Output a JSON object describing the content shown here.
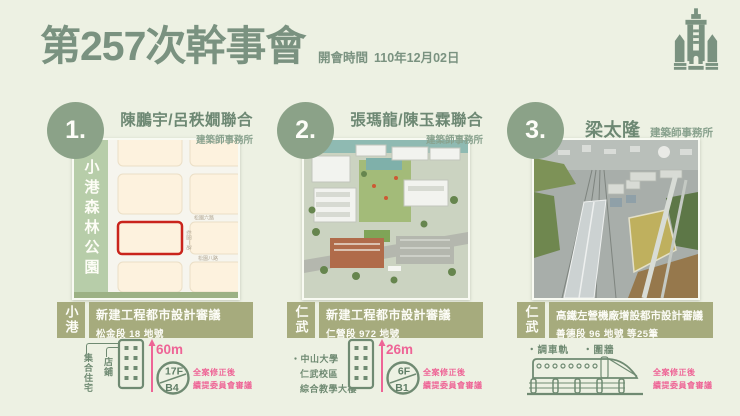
{
  "colors": {
    "accent_green": "#7a9280",
    "circle_green": "#8ba288",
    "banner_olive": "#a6ab7d",
    "pink": "#ee6496",
    "map_red": "#c9241c"
  },
  "header": {
    "title": "第257次幹事會",
    "meeting_time_label": "開會時間",
    "meeting_date": "110年12月02日"
  },
  "panels": [
    {
      "number": "1.",
      "firm": "陳鵬宇/呂秩嫺聯合",
      "firm_suffix": "建築師事務所",
      "district": "小港",
      "case_title": "新建工程都市設計審議",
      "case_lot": "松金段 18 地號",
      "map": {
        "park_label": "小港森林公園",
        "streets": [
          "松園六路",
          "松園一路",
          "松園八路"
        ]
      },
      "uses": [
        "集合住宅",
        "店鋪"
      ],
      "height": "60m",
      "floors_up": "17F",
      "floors_down": "B4",
      "status_line1": "全案修正後",
      "status_line2": "續提委員會審議"
    },
    {
      "number": "2.",
      "firm": "張瑪龍/陳玉霖聯合",
      "firm_suffix": "建築師事務所",
      "district": "仁武",
      "case_title": "新建工程都市設計審議",
      "case_lot": "仁營段 972 地號",
      "project_lines": [
        "・中山大學",
        "仁武校區",
        "綜合教學大樓"
      ],
      "height": "26m",
      "floors_up": "6F",
      "floors_down": "B1",
      "status_line1": "全案修正後",
      "status_line2": "續提委員會審議"
    },
    {
      "number": "3.",
      "firm": "梁太隆",
      "firm_suffix": "建築師事務所",
      "district": "仁武",
      "case_title": "高鐵左營機廠增設都市設計審議",
      "case_lot": "善德段 96 地號 等25筆",
      "features": [
        "・調車軌",
        "・圍牆"
      ],
      "status_line1": "全案修正後",
      "status_line2": "續提委員會審議"
    }
  ]
}
